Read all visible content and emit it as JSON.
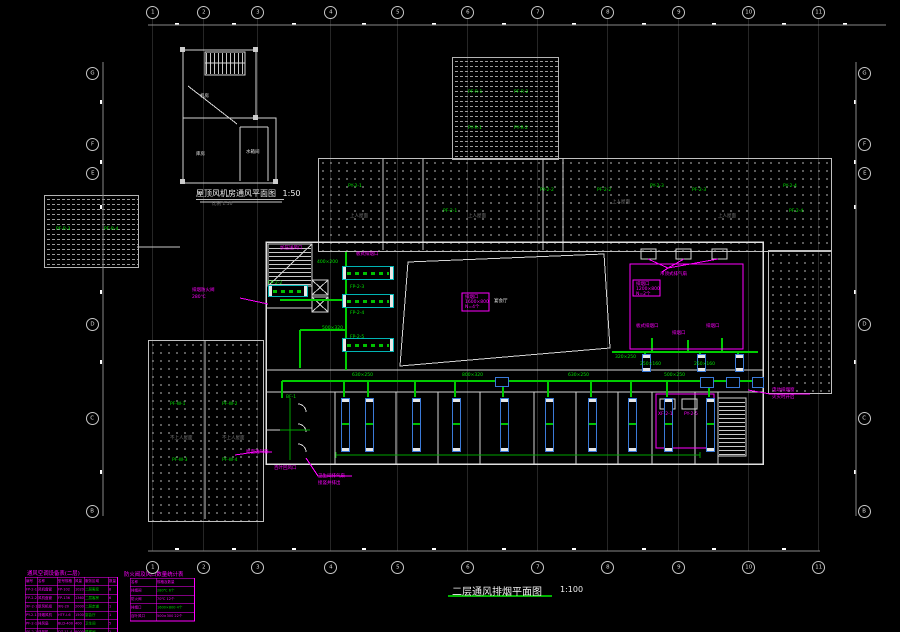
{
  "title": {
    "text": "二层通风排烟平面图",
    "scale": "1:100"
  },
  "inset": {
    "text": "屋顶风机房通风平面图",
    "scale": "1:50",
    "sub": "比例 1:50"
  },
  "colors": {
    "duct_green": "#00cc00",
    "annotation_magenta": "#ff00ff",
    "wall_white": "#d4d4d4",
    "hatch_gray": "#9a9a9a",
    "unit_blue": "#3b7ad8",
    "unit_cyan": "#00b4b4"
  },
  "grid": {
    "top": [
      {
        "n": "1",
        "x": 152
      },
      {
        "n": "2",
        "x": 203
      },
      {
        "n": "3",
        "x": 257
      },
      {
        "n": "4",
        "x": 330
      },
      {
        "n": "5",
        "x": 397
      },
      {
        "n": "6",
        "x": 467
      },
      {
        "n": "7",
        "x": 537
      },
      {
        "n": "8",
        "x": 607
      },
      {
        "n": "9",
        "x": 678
      },
      {
        "n": "10",
        "x": 748
      },
      {
        "n": "11",
        "x": 818
      }
    ],
    "bottom": [
      {
        "n": "1",
        "x": 152
      },
      {
        "n": "2",
        "x": 203
      },
      {
        "n": "3",
        "x": 257
      },
      {
        "n": "4",
        "x": 330
      },
      {
        "n": "5",
        "x": 397
      },
      {
        "n": "6",
        "x": 467
      },
      {
        "n": "7",
        "x": 537
      },
      {
        "n": "8",
        "x": 607
      },
      {
        "n": "9",
        "x": 678
      },
      {
        "n": "10",
        "x": 748
      },
      {
        "n": "11",
        "x": 818
      }
    ],
    "left": [
      {
        "n": "G",
        "y": 73
      },
      {
        "n": "F",
        "y": 144
      },
      {
        "n": "E",
        "y": 173
      },
      {
        "n": "D",
        "y": 324
      },
      {
        "n": "C",
        "y": 418
      },
      {
        "n": "B",
        "y": 511
      }
    ],
    "right": [
      {
        "n": "G",
        "y": 73
      },
      {
        "n": "F",
        "y": 144
      },
      {
        "n": "E",
        "y": 173
      },
      {
        "n": "D",
        "y": 324
      },
      {
        "n": "C",
        "y": 418
      },
      {
        "n": "B",
        "y": 511
      }
    ]
  },
  "labels": {
    "green": [
      [
        348,
        184,
        "PY-2-1"
      ],
      [
        443,
        209,
        "PF-2-1"
      ],
      [
        540,
        188,
        "PY-2-2"
      ],
      [
        597,
        188,
        "PF-2-2"
      ],
      [
        650,
        184,
        "PY-2-3"
      ],
      [
        692,
        188,
        "PF-2-3"
      ],
      [
        783,
        184,
        "PY-2-4"
      ],
      [
        789,
        209,
        "PF-2-4"
      ],
      [
        468,
        90,
        "PF-R-1"
      ],
      [
        514,
        90,
        "PF-R-2"
      ],
      [
        468,
        126,
        "PY-R-1"
      ],
      [
        514,
        126,
        "PY-R-2"
      ],
      [
        56,
        227,
        "PF-R-3"
      ],
      [
        104,
        227,
        "PF-R-4"
      ],
      [
        170,
        402,
        "PF-W-1"
      ],
      [
        222,
        402,
        "PF-W-2"
      ],
      [
        172,
        458,
        "PF-W-3"
      ],
      [
        222,
        458,
        "PF-W-4"
      ],
      [
        352,
        373,
        "630×250"
      ],
      [
        462,
        373,
        "800×320"
      ],
      [
        568,
        373,
        "630×250"
      ],
      [
        664,
        373,
        "500×250"
      ],
      [
        317,
        260,
        "400×200"
      ],
      [
        350,
        285,
        "FP-2-3"
      ],
      [
        350,
        311,
        "FP-2-4"
      ],
      [
        350,
        335,
        "FP-2-5"
      ],
      [
        268,
        281,
        "FP-2-2"
      ],
      [
        615,
        355,
        "320×250"
      ],
      [
        640,
        362,
        "250×160"
      ],
      [
        694,
        362,
        "250×160"
      ],
      [
        286,
        395,
        "BF-1"
      ],
      [
        322,
        326,
        "500×320"
      ]
    ],
    "gray": [
      [
        350,
        214,
        "上人屋面"
      ],
      [
        468,
        214,
        "上人屋面"
      ],
      [
        718,
        214,
        "上人屋面"
      ],
      [
        612,
        200,
        "上人屋面"
      ],
      [
        170,
        436,
        "不上人屋面"
      ],
      [
        222,
        436,
        "不上人屋面"
      ]
    ],
    "white": [
      [
        494,
        299,
        "宴会厅"
      ],
      [
        200,
        94,
        "机房"
      ],
      [
        196,
        152,
        "库房"
      ],
      [
        246,
        150,
        "水箱间"
      ]
    ],
    "magenta": [
      [
        192,
        288,
        "排烟防火阀"
      ],
      [
        192,
        295,
        "280℃"
      ],
      [
        280,
        246,
        "加压送风口"
      ],
      [
        356,
        252,
        "板式排烟口"
      ],
      [
        660,
        272,
        "吊顶式排气扇"
      ],
      [
        636,
        324,
        "板式排烟口"
      ],
      [
        672,
        331,
        "排烟口"
      ],
      [
        706,
        324,
        "排烟口"
      ],
      [
        318,
        474,
        "卫生间排气扇"
      ],
      [
        318,
        481,
        "接竖井排出"
      ],
      [
        274,
        466,
        "百叶回风口"
      ],
      [
        772,
        388,
        "电动排烟窗"
      ],
      [
        772,
        395,
        "火灾时开启"
      ],
      [
        465,
        295,
        "排烟口"
      ],
      [
        465,
        300,
        "1600×800"
      ],
      [
        465,
        305,
        "N=4个"
      ],
      [
        636,
        282,
        "排烟口"
      ],
      [
        636,
        287,
        "1200×800"
      ],
      [
        636,
        292,
        "N=2个"
      ],
      [
        658,
        412,
        "XF-2-1"
      ],
      [
        684,
        412,
        "PY-2-5"
      ],
      [
        246,
        450,
        "屋面透气管"
      ]
    ]
  },
  "units": {
    "vertical_x": [
      341,
      365,
      412,
      452,
      500,
      545,
      588,
      628,
      664,
      706
    ],
    "risers": [
      [
        642,
        354
      ],
      [
        697,
        354
      ],
      [
        735,
        354
      ]
    ],
    "horizontal": [
      [
        342,
        266,
        50,
        12
      ],
      [
        342,
        294,
        50,
        12
      ],
      [
        342,
        338,
        50,
        12
      ],
      [
        268,
        285,
        38,
        10
      ]
    ],
    "fittings": [
      [
        700,
        377,
        12,
        9
      ],
      [
        726,
        377,
        12,
        9
      ],
      [
        752,
        377,
        10,
        9
      ],
      [
        495,
        377,
        12,
        8
      ]
    ]
  },
  "dims": {
    "top_ticks": [
      175,
      232,
      292,
      362,
      432,
      502,
      572,
      642,
      712,
      782,
      843
    ],
    "bottom_ticks": [
      175,
      232,
      292,
      362,
      432,
      502,
      572,
      642,
      712,
      782
    ],
    "left_ticks": [
      100,
      160,
      205,
      290,
      360,
      470
    ],
    "right_ticks": [
      100,
      160,
      205,
      290,
      360,
      470
    ]
  },
  "tables": {
    "left": {
      "title": "通风空调设备表(二层)",
      "cols": [
        24,
        40,
        34,
        20,
        48,
        18
      ],
      "green_col": 4,
      "rows": [
        [
          "编号",
          "名称",
          "型号规格",
          "风量",
          "服务区域",
          "数量"
        ],
        [
          "FP-2-1",
          "风机盘管",
          "FP-102",
          "1020",
          "二层客房",
          "8"
        ],
        [
          "FP-2-2",
          "风机盘管",
          "FP-136",
          "1360",
          "二层客房",
          "6"
        ],
        [
          "XF-2-1",
          "新风机组",
          "XFJ-20",
          "2000",
          "二层走道",
          "1"
        ],
        [
          "PY-2-1",
          "排烟风机",
          "HTF-I-6",
          "15000",
          "宴会厅",
          "1"
        ],
        [
          "PF-2-1",
          "排风扇",
          "BLD-400",
          "400",
          "卫生间",
          "5"
        ],
        [
          "SF-2-1",
          "送风机",
          "DZ-11-4",
          "8000",
          "楼梯间",
          "1"
        ]
      ]
    },
    "right": {
      "title": "防火阀及风口数量统计表",
      "cols": [
        52,
        76
      ],
      "rows": [
        [
          "名称",
          "规格及数量"
        ],
        [
          "排烟阀",
          "280℃  6个"
        ],
        [
          "防火阀",
          "70℃  12个"
        ],
        [
          "排烟口",
          "1600×800  4个"
        ],
        [
          "百叶风口",
          "500×300  22个"
        ]
      ],
      "green_cells": [
        [
          1,
          1
        ],
        [
          3,
          1
        ]
      ]
    }
  }
}
